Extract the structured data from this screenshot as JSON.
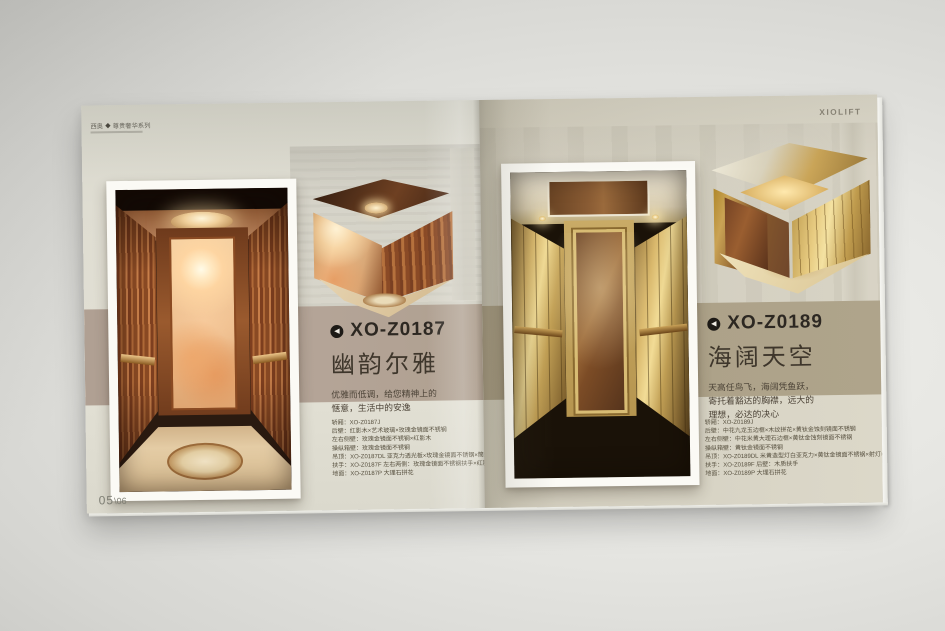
{
  "brand": {
    "logo_text": "XIOLIFT"
  },
  "icons": {
    "title_pointer": "◀",
    "series_logo": "◆"
  },
  "colors": {
    "band_left": "#b3a296",
    "band_right": "#aca188",
    "page_left": "#e0ded3",
    "page_right": "#d7d3c4",
    "accent_copper": "#b06a38",
    "accent_gold": "#caa95e",
    "title_text": "#2d2822"
  },
  "left_page": {
    "header": {
      "prefix": "西奥",
      "suffix": "尊贵奢华系列"
    },
    "product": {
      "model": "XO-Z0187",
      "name": "幽韵尔雅",
      "description": [
        "优雅而低调，给您精神上的",
        "惬意，生活中的安逸"
      ]
    },
    "specs": [
      "轿厢：XO-Z0187J",
      "后壁：红影木×艺术玻璃×玫瑰金镜面不锈钢",
      "左右侧壁：玫瑰金镜面不锈钢×红影木",
      "操纵箱壁：玫瑰金镜面不锈钢",
      "吊顶：XO-Z0187DL 亚克力透光板×玫瑰金镜面不锈钢×筒灯×吊灯",
      "扶手：XO-Z0187F 左右两侧：玫瑰金镜面不锈钢扶手×红影木",
      "地面：XO-Z0187P 大理石拼花"
    ],
    "page_number": {
      "main": "05",
      "sub": "\\06"
    }
  },
  "right_page": {
    "brand": "XIOLIFT",
    "product": {
      "model": "XO-Z0189",
      "name": "海阔天空",
      "description": [
        "天高任鸟飞，海阔凭鱼跃，",
        "寄托着豁达的胸襟，远大的",
        "理想，必达的决心"
      ]
    },
    "specs": [
      "轿厢：XO-Z0189J",
      "后壁：中花九龙玉边框×木纹拼花×黄钛金蚀刻镜面不锈钢",
      "左右侧壁：中花米黄大理石边框×黄钛金蚀刻镜面不锈钢",
      "操纵箱壁：黄钛金镜面不锈钢",
      "吊顶：XO-Z0189DL 米黄造型灯白亚克力×黄钛金镜面不锈钢×射灯×组合灯带",
      "扶手：XO-Z0189F 后壁：木质扶手",
      "地面：XO-Z0189P 大理石拼花"
    ]
  }
}
